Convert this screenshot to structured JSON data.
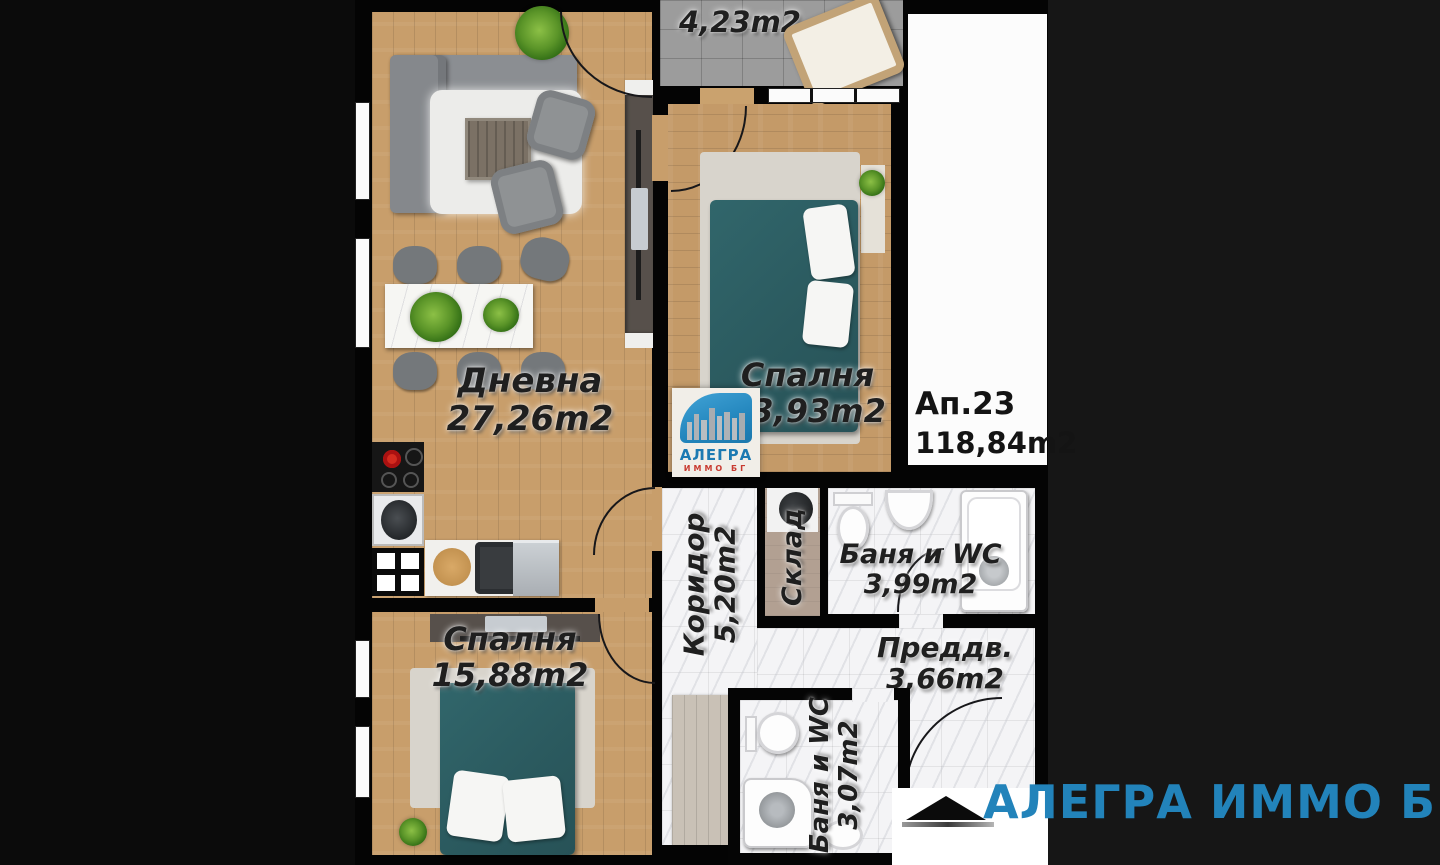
{
  "apartment": {
    "number": "Ап.23",
    "total_area": "118,84m2"
  },
  "rooms": {
    "living": {
      "name": "Дневна",
      "area": "27,26m2"
    },
    "bedroom_right": {
      "name": "Спалня",
      "area": "13,93m2"
    },
    "bedroom_left": {
      "name": "Спалня",
      "area": "15,88m2"
    },
    "balcony": {
      "area": "4,23m2"
    },
    "corridor": {
      "name": "Коридор",
      "area": "5,20m2"
    },
    "storage": {
      "name": "Склад"
    },
    "bathroom_main": {
      "name": "Баня и WC",
      "area": "3,99m2"
    },
    "bathroom_second": {
      "name": "Баня и WC",
      "area": "3,07m2"
    },
    "entry": {
      "name": "Преддв.",
      "area": "3,66m2"
    }
  },
  "logo": {
    "brand": "АЛЕГРА",
    "subtitle": "ИММО БГ"
  },
  "watermark": {
    "brand": "АЛЕГРА ИММО БГ"
  },
  "colors": {
    "brand_blue": "#2283ba",
    "logo_red": "#c83a30",
    "bed_teal": "#2d5e63",
    "wood": "#c89e6b"
  }
}
